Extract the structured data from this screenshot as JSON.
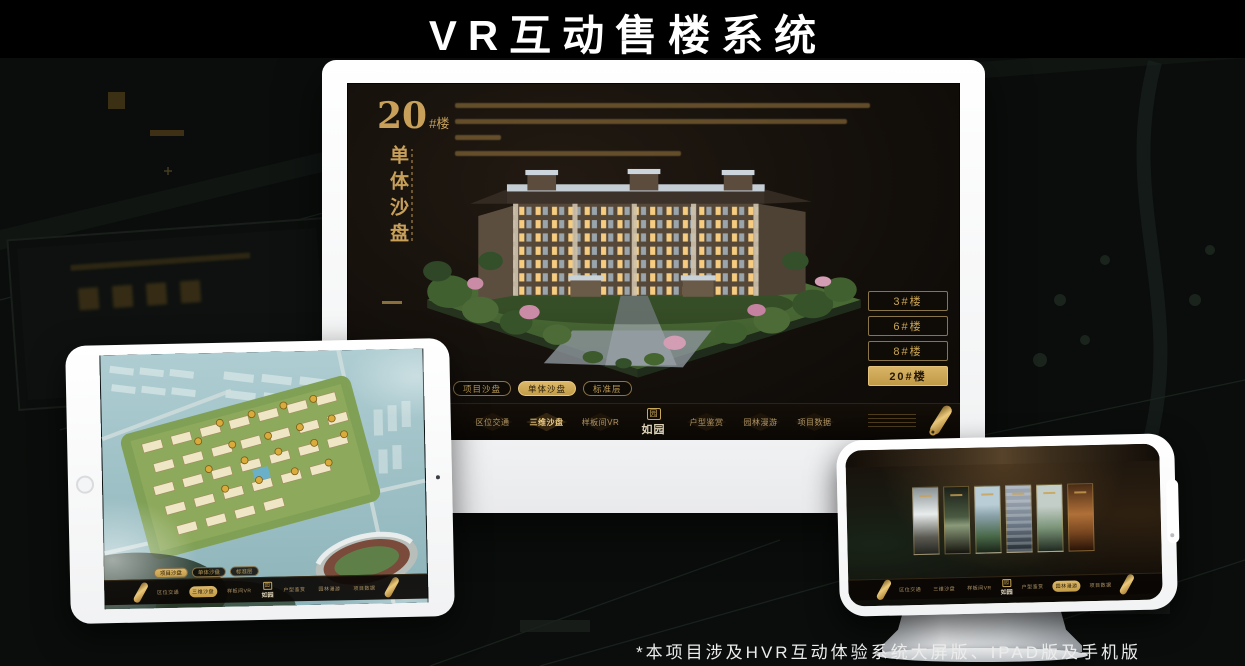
{
  "title": {
    "text": "VR互动售楼系统"
  },
  "footnote": {
    "text": "*本项目涉及HVR互动体验系统大屏版、IPAD版及手机版"
  },
  "colors": {
    "accent_gold": "#c9a455",
    "gold_text": "#c8a05a",
    "device_white": "#ffffff",
    "screen_dark": "#17120d",
    "map_teal": "#9fc2ca"
  },
  "monitor": {
    "heading": {
      "number": "20",
      "suffix": "#楼",
      "vertical": "单体沙盘"
    },
    "floor_buttons": [
      {
        "label": "3#楼",
        "active": false
      },
      {
        "label": "6#楼",
        "active": false
      },
      {
        "label": "8#楼",
        "active": false
      },
      {
        "label": "20#楼",
        "active": true
      }
    ],
    "tabs": [
      {
        "label": "项目沙盘",
        "active": false
      },
      {
        "label": "单体沙盘",
        "active": true
      },
      {
        "label": "标准层",
        "active": false
      }
    ],
    "nav": {
      "logo_seal": "园",
      "logo": "如园",
      "items": [
        {
          "label": "区位交通",
          "active": false
        },
        {
          "label": "三维沙盘",
          "active": true
        },
        {
          "label": "样板间VR",
          "active": false
        },
        {
          "label": "户型鉴赏",
          "active": false
        },
        {
          "label": "园林漫游",
          "active": false
        },
        {
          "label": "项目数据",
          "active": false
        }
      ]
    }
  },
  "tablet": {
    "tabs": [
      {
        "label": "项目沙盘",
        "active": true
      },
      {
        "label": "单体沙盘",
        "active": false
      },
      {
        "label": "标准层",
        "active": false
      }
    ],
    "nav": {
      "logo_seal": "园",
      "logo": "如园",
      "items": [
        {
          "label": "区位交通",
          "active": false
        },
        {
          "label": "三维沙盘",
          "active": true
        },
        {
          "label": "样板间VR",
          "active": false
        },
        {
          "label": "户型鉴赏",
          "active": false
        },
        {
          "label": "园林漫游",
          "active": false
        },
        {
          "label": "项目数据",
          "active": false
        }
      ]
    }
  },
  "phone": {
    "nav": {
      "logo_seal": "园",
      "logo": "如园",
      "items": [
        {
          "label": "区位交通",
          "active": false
        },
        {
          "label": "三维沙盘",
          "active": false
        },
        {
          "label": "样板间VR",
          "active": false
        },
        {
          "label": "户型鉴赏",
          "active": false
        },
        {
          "label": "园林漫游",
          "active": true
        },
        {
          "label": "项目数据",
          "active": false
        }
      ]
    }
  }
}
